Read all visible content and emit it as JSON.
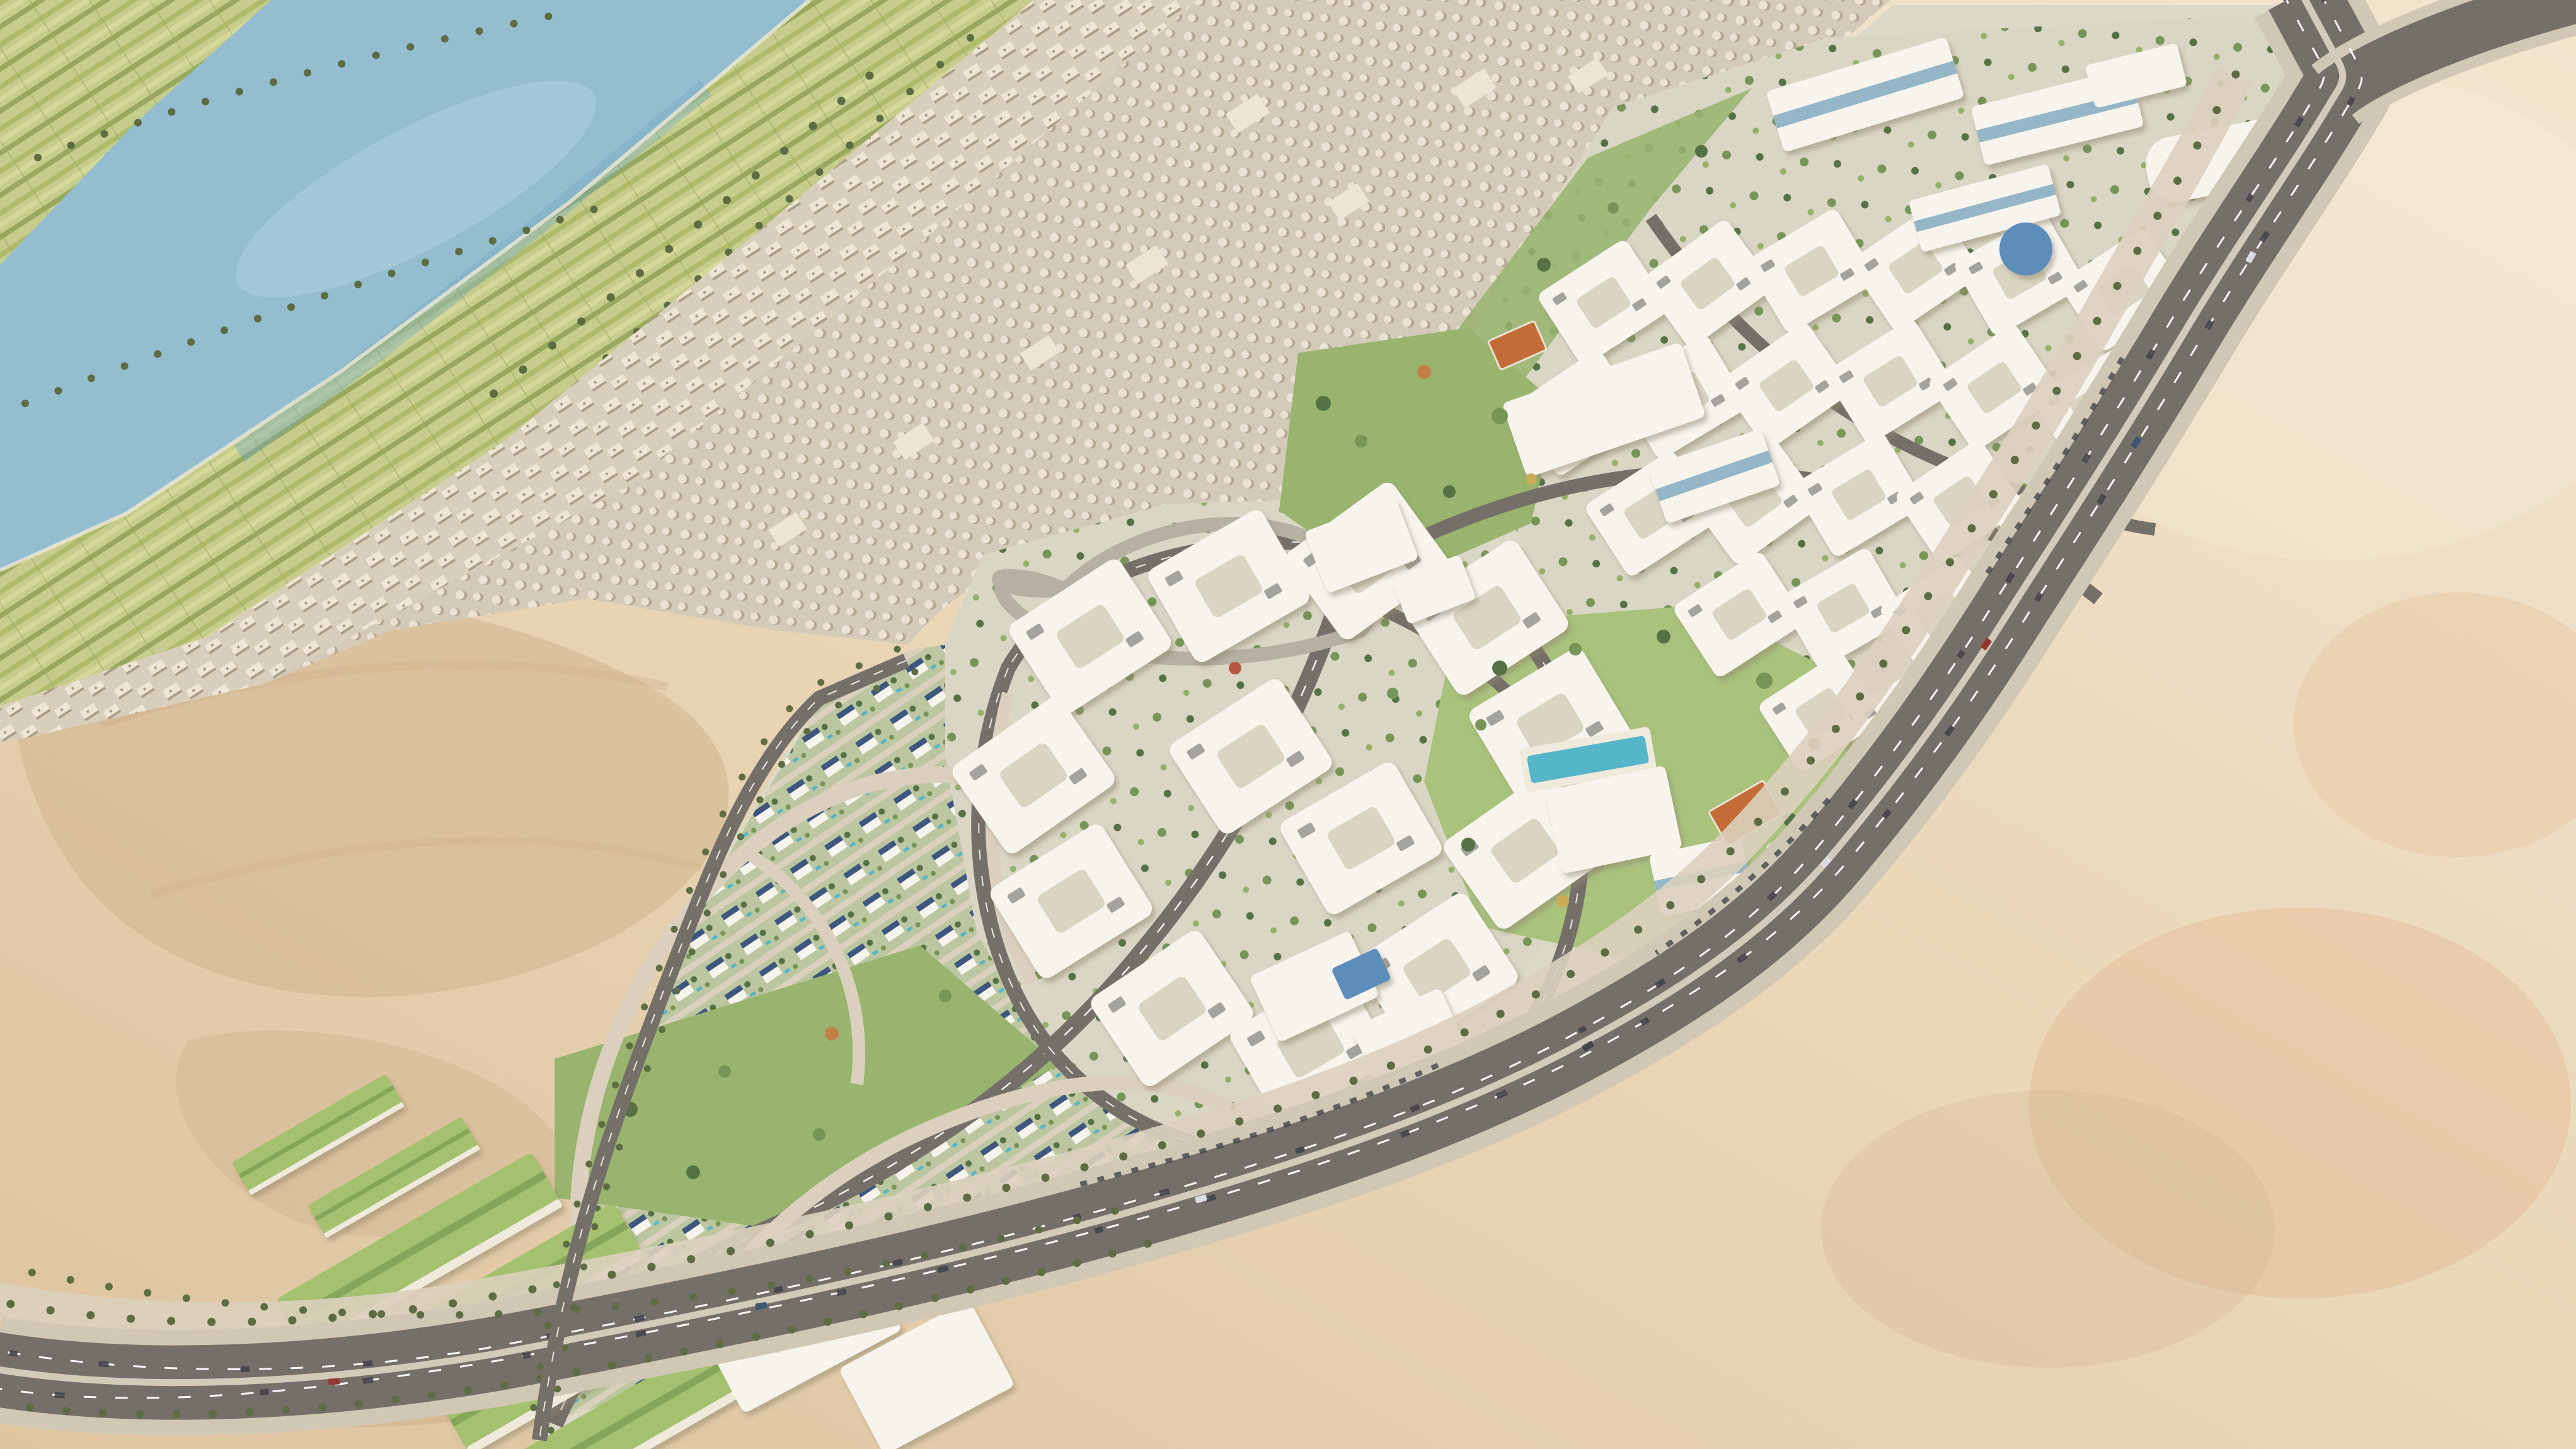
{
  "scene": {
    "type": "aerial-architectural-rendering",
    "description": "High-angle aerial masterplan rendering of a large gated residential development built on a desert plateau beside a river valley. The elongated compound runs diagonally from the lower left to the upper right, bounded by a palm-lined ring highway with traffic. Inside are white courtyard apartment blocks, villa neighborhoods with rooftop solar panels, curving streets, central parks, a clubhouse with swimming pool, orange sports courts, a green-roofed school campus and a gateway complex. Across the desert to the upper left lies a strip of green farmland with palm groves on both banks of a blue river, and a dense historic town of small domed structures between the farmland and the desert.",
    "view": "oblique aerial view",
    "lighting": "bright desert daylight, warm haze toward the upper right",
    "no_text_visible": true,
    "regions": [
      {
        "name": "river",
        "description": "speckled blue river crossing the top-left corner diagonally"
      },
      {
        "name": "farmland-far-bank",
        "description": "striped green agricultural plots with palm trees on the far river bank"
      },
      {
        "name": "farmland-near-bank",
        "description": "terraced striped fields and palm clusters on the near river bank"
      },
      {
        "name": "old-town-strip",
        "description": "band of flat-roofed beige buildings along the fields"
      },
      {
        "name": "necropolis",
        "description": "vast field of small pale domed structures between the town strip and the desert"
      },
      {
        "name": "desert",
        "description": "sandy beige desert with dune shading surrounding the development"
      },
      {
        "name": "residential-compound",
        "description": "master-planned development band running diagonally across the frame"
      },
      {
        "name": "villa-district",
        "description": "south-west half of the compound: small white villas with dark solar roofs, greenery and cream streets"
      },
      {
        "name": "central-apartment-cluster",
        "description": "rings of white courtyard apartment blocks around a loop road"
      },
      {
        "name": "north-apartment-district",
        "description": "dense rows of white courtyard blocks toward the top right"
      },
      {
        "name": "campus-buildings",
        "description": "large white institutional buildings with blue glass along the top edge"
      },
      {
        "name": "school-complex",
        "description": "four long green-roofed buildings with white annex blocks at the bottom left of the compound"
      },
      {
        "name": "gateway-complex",
        "description": "white entrance buildings with a looping access ramp around a sand knoll"
      },
      {
        "name": "community-mall",
        "description": "large white commercial buildings north-east of the gateway"
      },
      {
        "name": "clubhouse",
        "description": "modern white clubhouse with lap pool and sun deck in the central park"
      },
      {
        "name": "sports-courts",
        "description": "orange game courts set in lawns"
      },
      {
        "name": "office-complex",
        "description": "white office/medical buildings with blue glass beside the highway"
      },
      {
        "name": "ring-highway",
        "description": "dual-carriageway highway with white lane dashes, median, frontage parking and traffic"
      },
      {
        "name": "boulevard",
        "description": "palm-lined boulevard along the south-west edge"
      },
      {
        "name": "west-street",
        "description": "straight palm-lined street forming the western boundary"
      }
    ]
  },
  "palette": {
    "desert_light": "#f2e6cf",
    "desert_mid": "#e9d6b5",
    "desert_deep": "#ddc39c",
    "desert_shadow": "#c9a87e",
    "desert_pink": "#dfae85",
    "haze_white": "#f8f0e2",
    "water": "#8fbccf",
    "water_light": "#abd0dd",
    "water_deep": "#6fa6bf",
    "shoreline": "#eee8d5",
    "farm_base": "#c2cb87",
    "farm_stripe_a": "#aab964",
    "farm_stripe_b": "#d3d795",
    "farm_stripe_c": "#93a556",
    "palm_dark": "#55663a",
    "tree_dark": "#4c6c3c",
    "tree_mid": "#6f9150",
    "tree_light": "#8fae61",
    "tree_autumn": "#c07a40",
    "tree_red": "#b04f35",
    "tree_gold": "#c9a84c",
    "town_base": "#d6cdba",
    "town_building": "#ece5d5",
    "town_shadow": "#a79a82",
    "dome_base": "#d2c9b7",
    "dome_light": "#e9e2d3",
    "dome_shadow": "#b2a58f",
    "dev_ground": "#dcd8c7",
    "park_ground": "#d8d5c4",
    "villa_ground": "#b9c49c",
    "street_light": "#d9cfbb",
    "street_ramp": "#b3ada0",
    "asphalt": "#6e6963",
    "curb": "#cfc6b3",
    "median": "#d2c9b8",
    "lane_white": "#ffffff",
    "car_dark": "#383d44",
    "car_white": "#d8dde2",
    "car_blue": "#32506e",
    "car_red": "#8e2f26",
    "building_white": "#f7f5ef",
    "building_cream": "#f1ead9",
    "courtyard": "#d8d3c0",
    "pergola": "#5a5a52",
    "glass_blue": "#8fb4c6",
    "glass_deep": "#5588b8",
    "solar_blue": "#34507a",
    "green_roof": "#9fbf68",
    "green_roof_dark": "#7da352",
    "lawn": "#93b268",
    "lawn_light": "#a5c178",
    "white_deck": "#efeadb",
    "pool": "#4db3c8",
    "court_orange": "#c0662f"
  }
}
